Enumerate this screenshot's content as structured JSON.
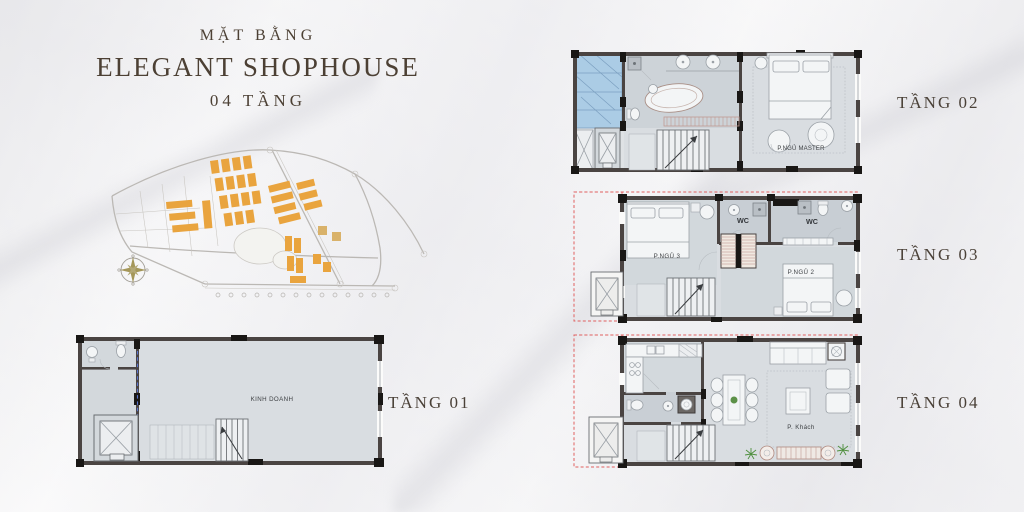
{
  "title": {
    "subtitle": "MẶT BẰNG",
    "main": "ELEGANT SHOPHOUSE",
    "floors_count": "04 TẦNG"
  },
  "floor_labels": {
    "f1": "TẦNG 01",
    "f2": "TẦNG 02",
    "f3": "TẦNG 03",
    "f4": "TẦNG 04"
  },
  "rooms": {
    "f1_business": "KINH DOANH",
    "f2_master": "P.NGỦ MASTER",
    "f3_bed3": "P.NGỦ 3",
    "f3_bed2": "P.NGỦ 2",
    "f3_wc1": "WC",
    "f3_wc2": "WC",
    "f4_living": "P. Khách"
  },
  "colors": {
    "title_brown": "#4c4034",
    "wall_dark": "#4a4442",
    "floor_gray": "#d9dde1",
    "glass_blue": "#abcce5",
    "void_red_dash": "#e06060",
    "masterplan_orange": "#e9a43e",
    "compass_gold": "#a5975a",
    "marble_bg": "#f8f7f6"
  }
}
